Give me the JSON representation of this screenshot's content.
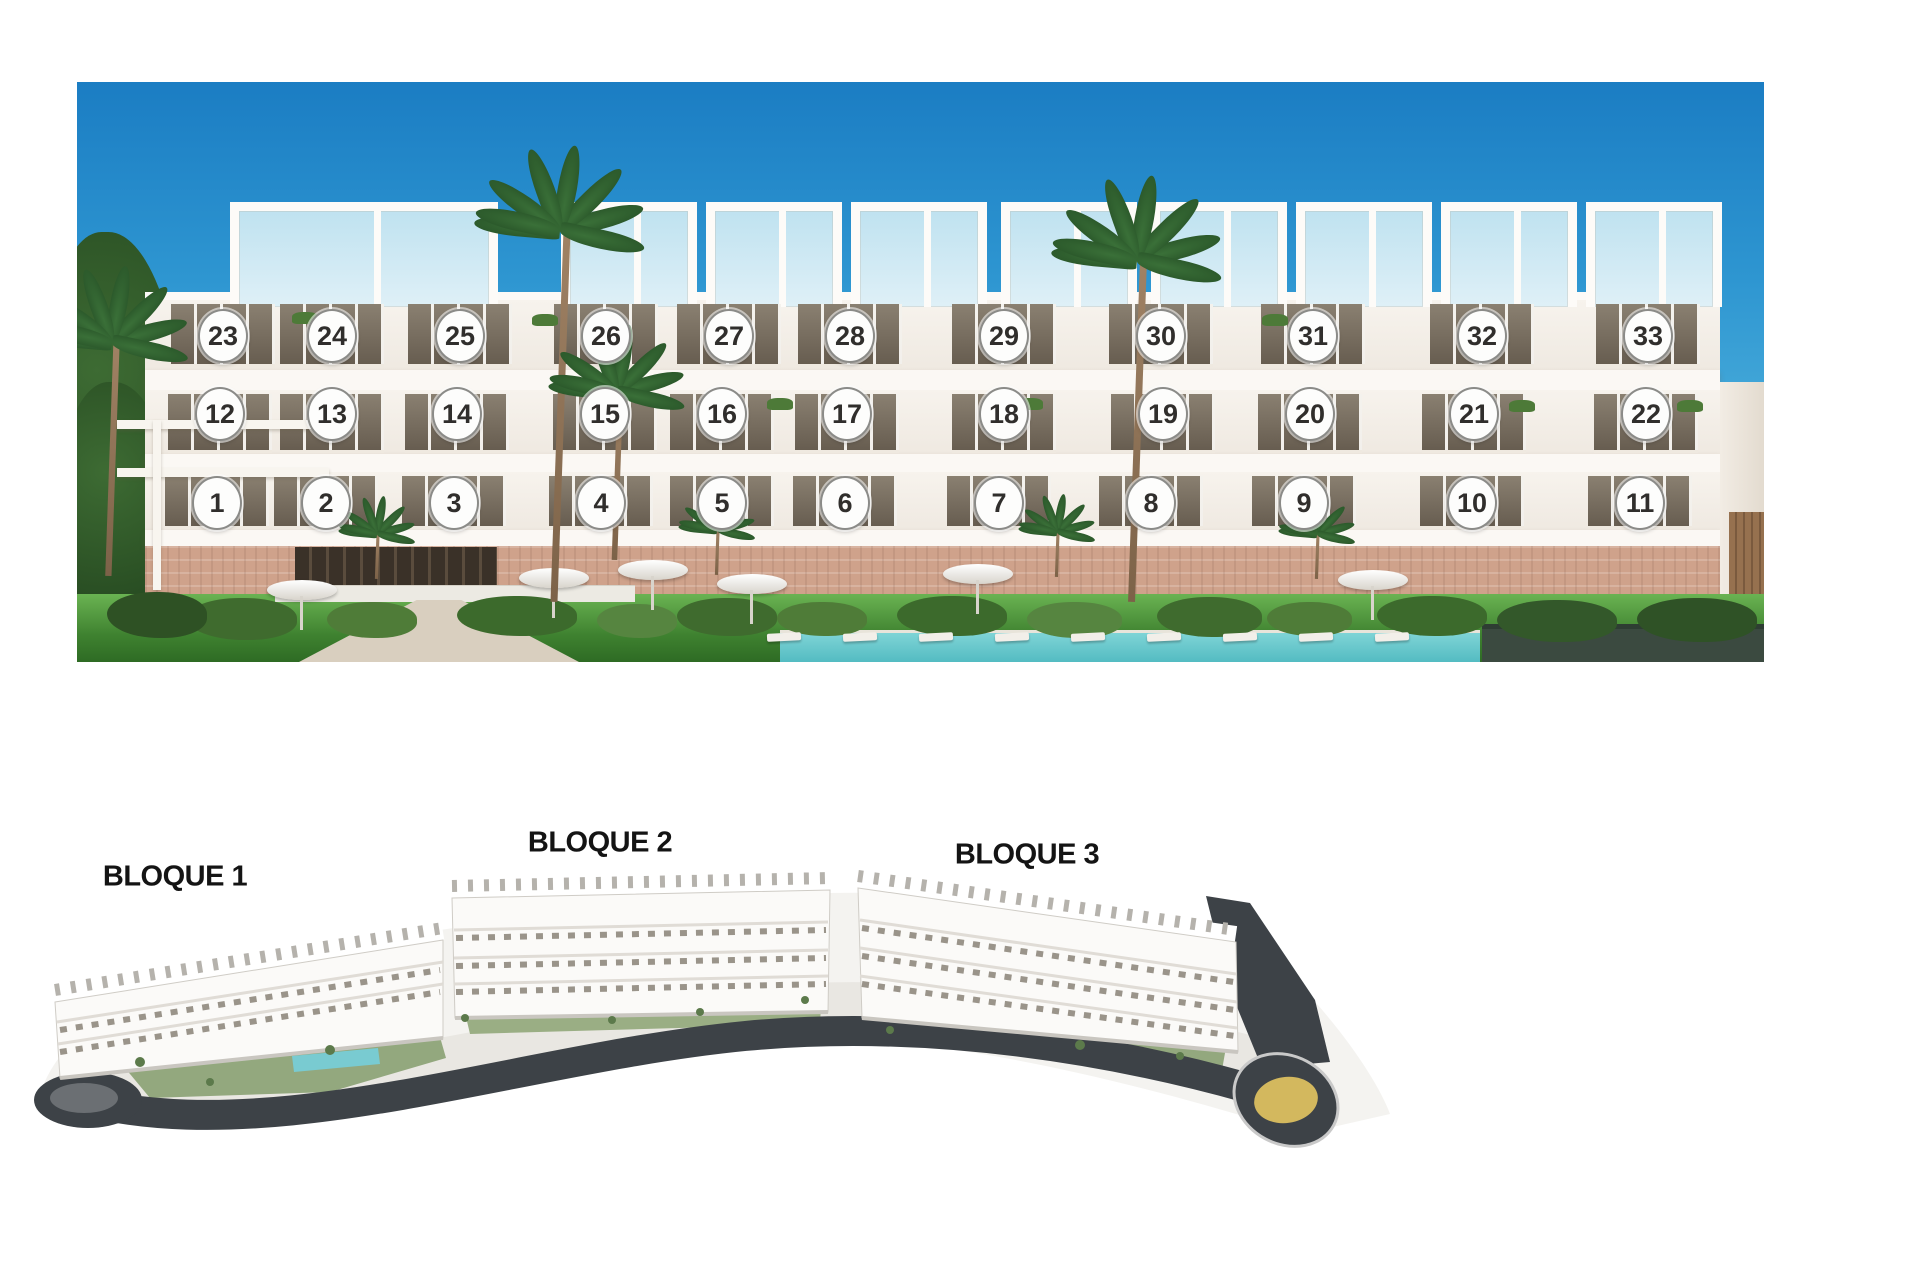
{
  "canvas": {
    "width": 1920,
    "height": 1280,
    "background": "#ffffff"
  },
  "elevation_photo": {
    "frame": {
      "left": 77,
      "top": 82,
      "width": 1687,
      "height": 580
    },
    "floors": [
      {
        "name": "top-floor-row",
        "circle_y": 336,
        "units": [
          [
            "23",
            223
          ],
          [
            "24",
            332
          ],
          [
            "25",
            460
          ],
          [
            "26",
            606
          ],
          [
            "27",
            729
          ],
          [
            "28",
            850
          ],
          [
            "29",
            1004
          ],
          [
            "30",
            1161
          ],
          [
            "31",
            1313
          ],
          [
            "32",
            1482
          ],
          [
            "33",
            1648
          ]
        ]
      },
      {
        "name": "middle-floor-row",
        "circle_y": 414,
        "units": [
          [
            "12",
            220
          ],
          [
            "13",
            332
          ],
          [
            "14",
            457
          ],
          [
            "15",
            605
          ],
          [
            "16",
            722
          ],
          [
            "17",
            847
          ],
          [
            "18",
            1004
          ],
          [
            "19",
            1163
          ],
          [
            "20",
            1310
          ],
          [
            "21",
            1474
          ],
          [
            "22",
            1646
          ]
        ]
      },
      {
        "name": "ground-floor-row",
        "circle_y": 503,
        "units": [
          [
            "1",
            217
          ],
          [
            "2",
            326
          ],
          [
            "3",
            454
          ],
          [
            "4",
            601
          ],
          [
            "5",
            722
          ],
          [
            "6",
            845
          ],
          [
            "7",
            999
          ],
          [
            "8",
            1151
          ],
          [
            "9",
            1304
          ],
          [
            "10",
            1472
          ],
          [
            "11",
            1640
          ]
        ]
      }
    ],
    "circle_style": {
      "fill": "#fdfdfc",
      "border": "#8b8b88",
      "number_color": "#302e2c"
    },
    "colors": {
      "sky_top": "#1b7dc3",
      "sky_horizon": "#a6d7ec",
      "facade": "#f4efe9",
      "stone_base": "#cfa28b",
      "glass": "#6e6456",
      "grass": "#5aa647",
      "pool": "#62c8cc",
      "hedge": "#3b4a40"
    }
  },
  "site_plan": {
    "labels": [
      {
        "text": "BLOQUE 1",
        "x": 175,
        "y": 877
      },
      {
        "text": "BLOQUE 2",
        "x": 600,
        "y": 843
      },
      {
        "text": "BLOQUE 3",
        "x": 1027,
        "y": 855
      }
    ],
    "colors": {
      "ground": "#f4f3f0",
      "road": "#3d4247",
      "green": "#95aa80",
      "pool": "#79cbd1",
      "building": "#fbfaf8",
      "roundabout_center": "#d3b85e"
    }
  }
}
